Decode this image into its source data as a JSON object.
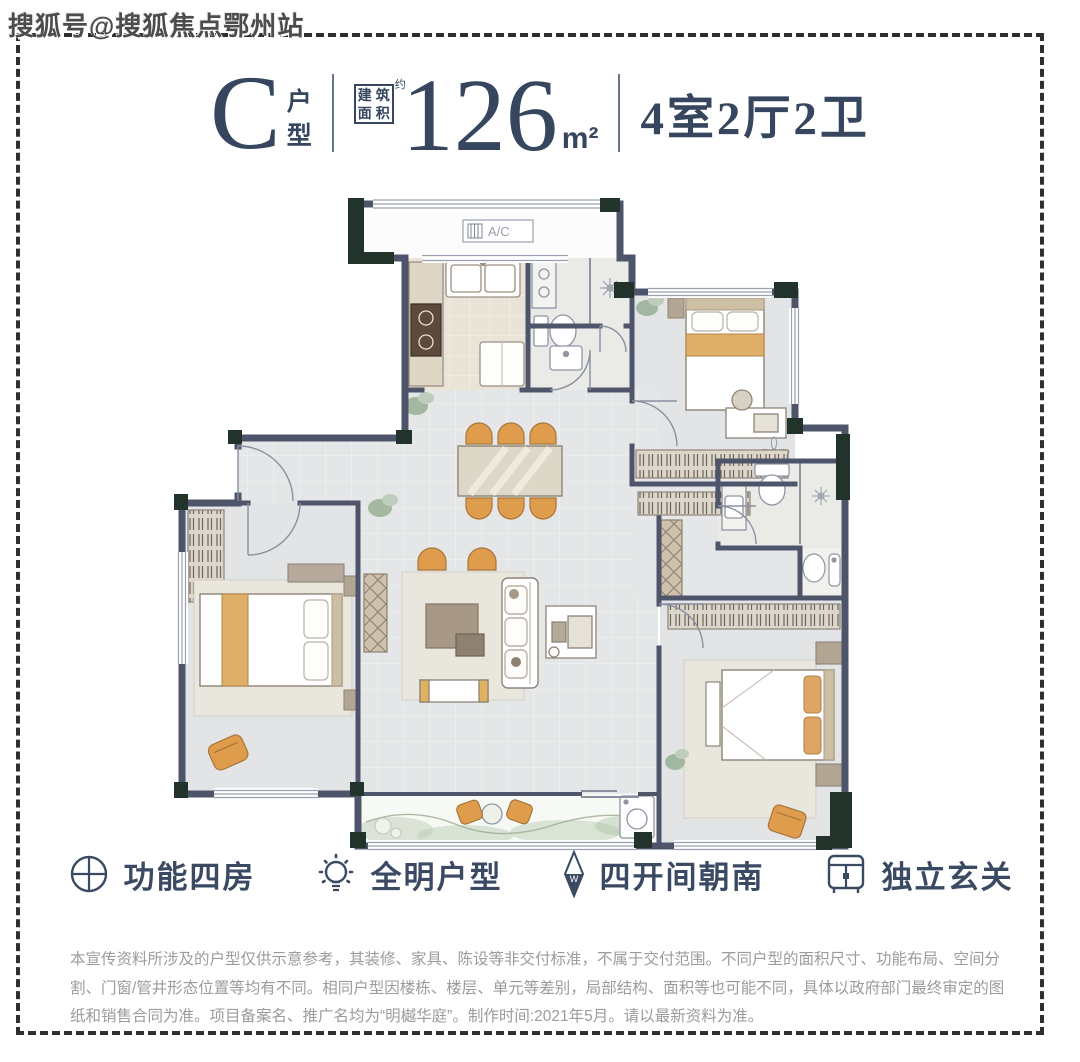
{
  "watermark": "搜狐号@搜狐焦点鄂州站",
  "header": {
    "type_letter": "C",
    "type_suffix_chars": [
      "户",
      "型"
    ],
    "area_box_chars": [
      "建",
      "筑",
      "面",
      "积"
    ],
    "area_approx": "约",
    "area_value": "126",
    "area_unit": "m²",
    "rooms": "4室2厅2卫"
  },
  "floorplan": {
    "ac_label": "A/C"
  },
  "features": [
    {
      "icon": "circle-plus-icon",
      "label": "功能四房"
    },
    {
      "icon": "bulb-icon",
      "label": "全明户型"
    },
    {
      "icon": "compass-needle-icon",
      "label": "四开间朝南"
    },
    {
      "icon": "cabinet-icon",
      "label": "独立玄关"
    }
  ],
  "disclaimer": "本宣传资料所涉及的户型仅供示意参考，其装修、家具、陈设等非交付标准，不属于交付范围。不同户型的面积尺寸、功能布局、空间分割、门窗/管井形态位置等均有不同。相同户型因楼栋、楼层、单元等差别，局部结构、面积等也可能不同，具体以政府部门最终审定的图纸和销售合同为准。项目备案名、推广名均为“明樾华庭”。制作时间:2021年5月。请以最新资料为准。",
  "colors": {
    "text_primary": "#36465f",
    "wall_dark": "#22332b",
    "wall_slate": "#4e556a",
    "furniture_orange": "#df9c4c",
    "disclaimer_gray": "#9b9b9b"
  }
}
